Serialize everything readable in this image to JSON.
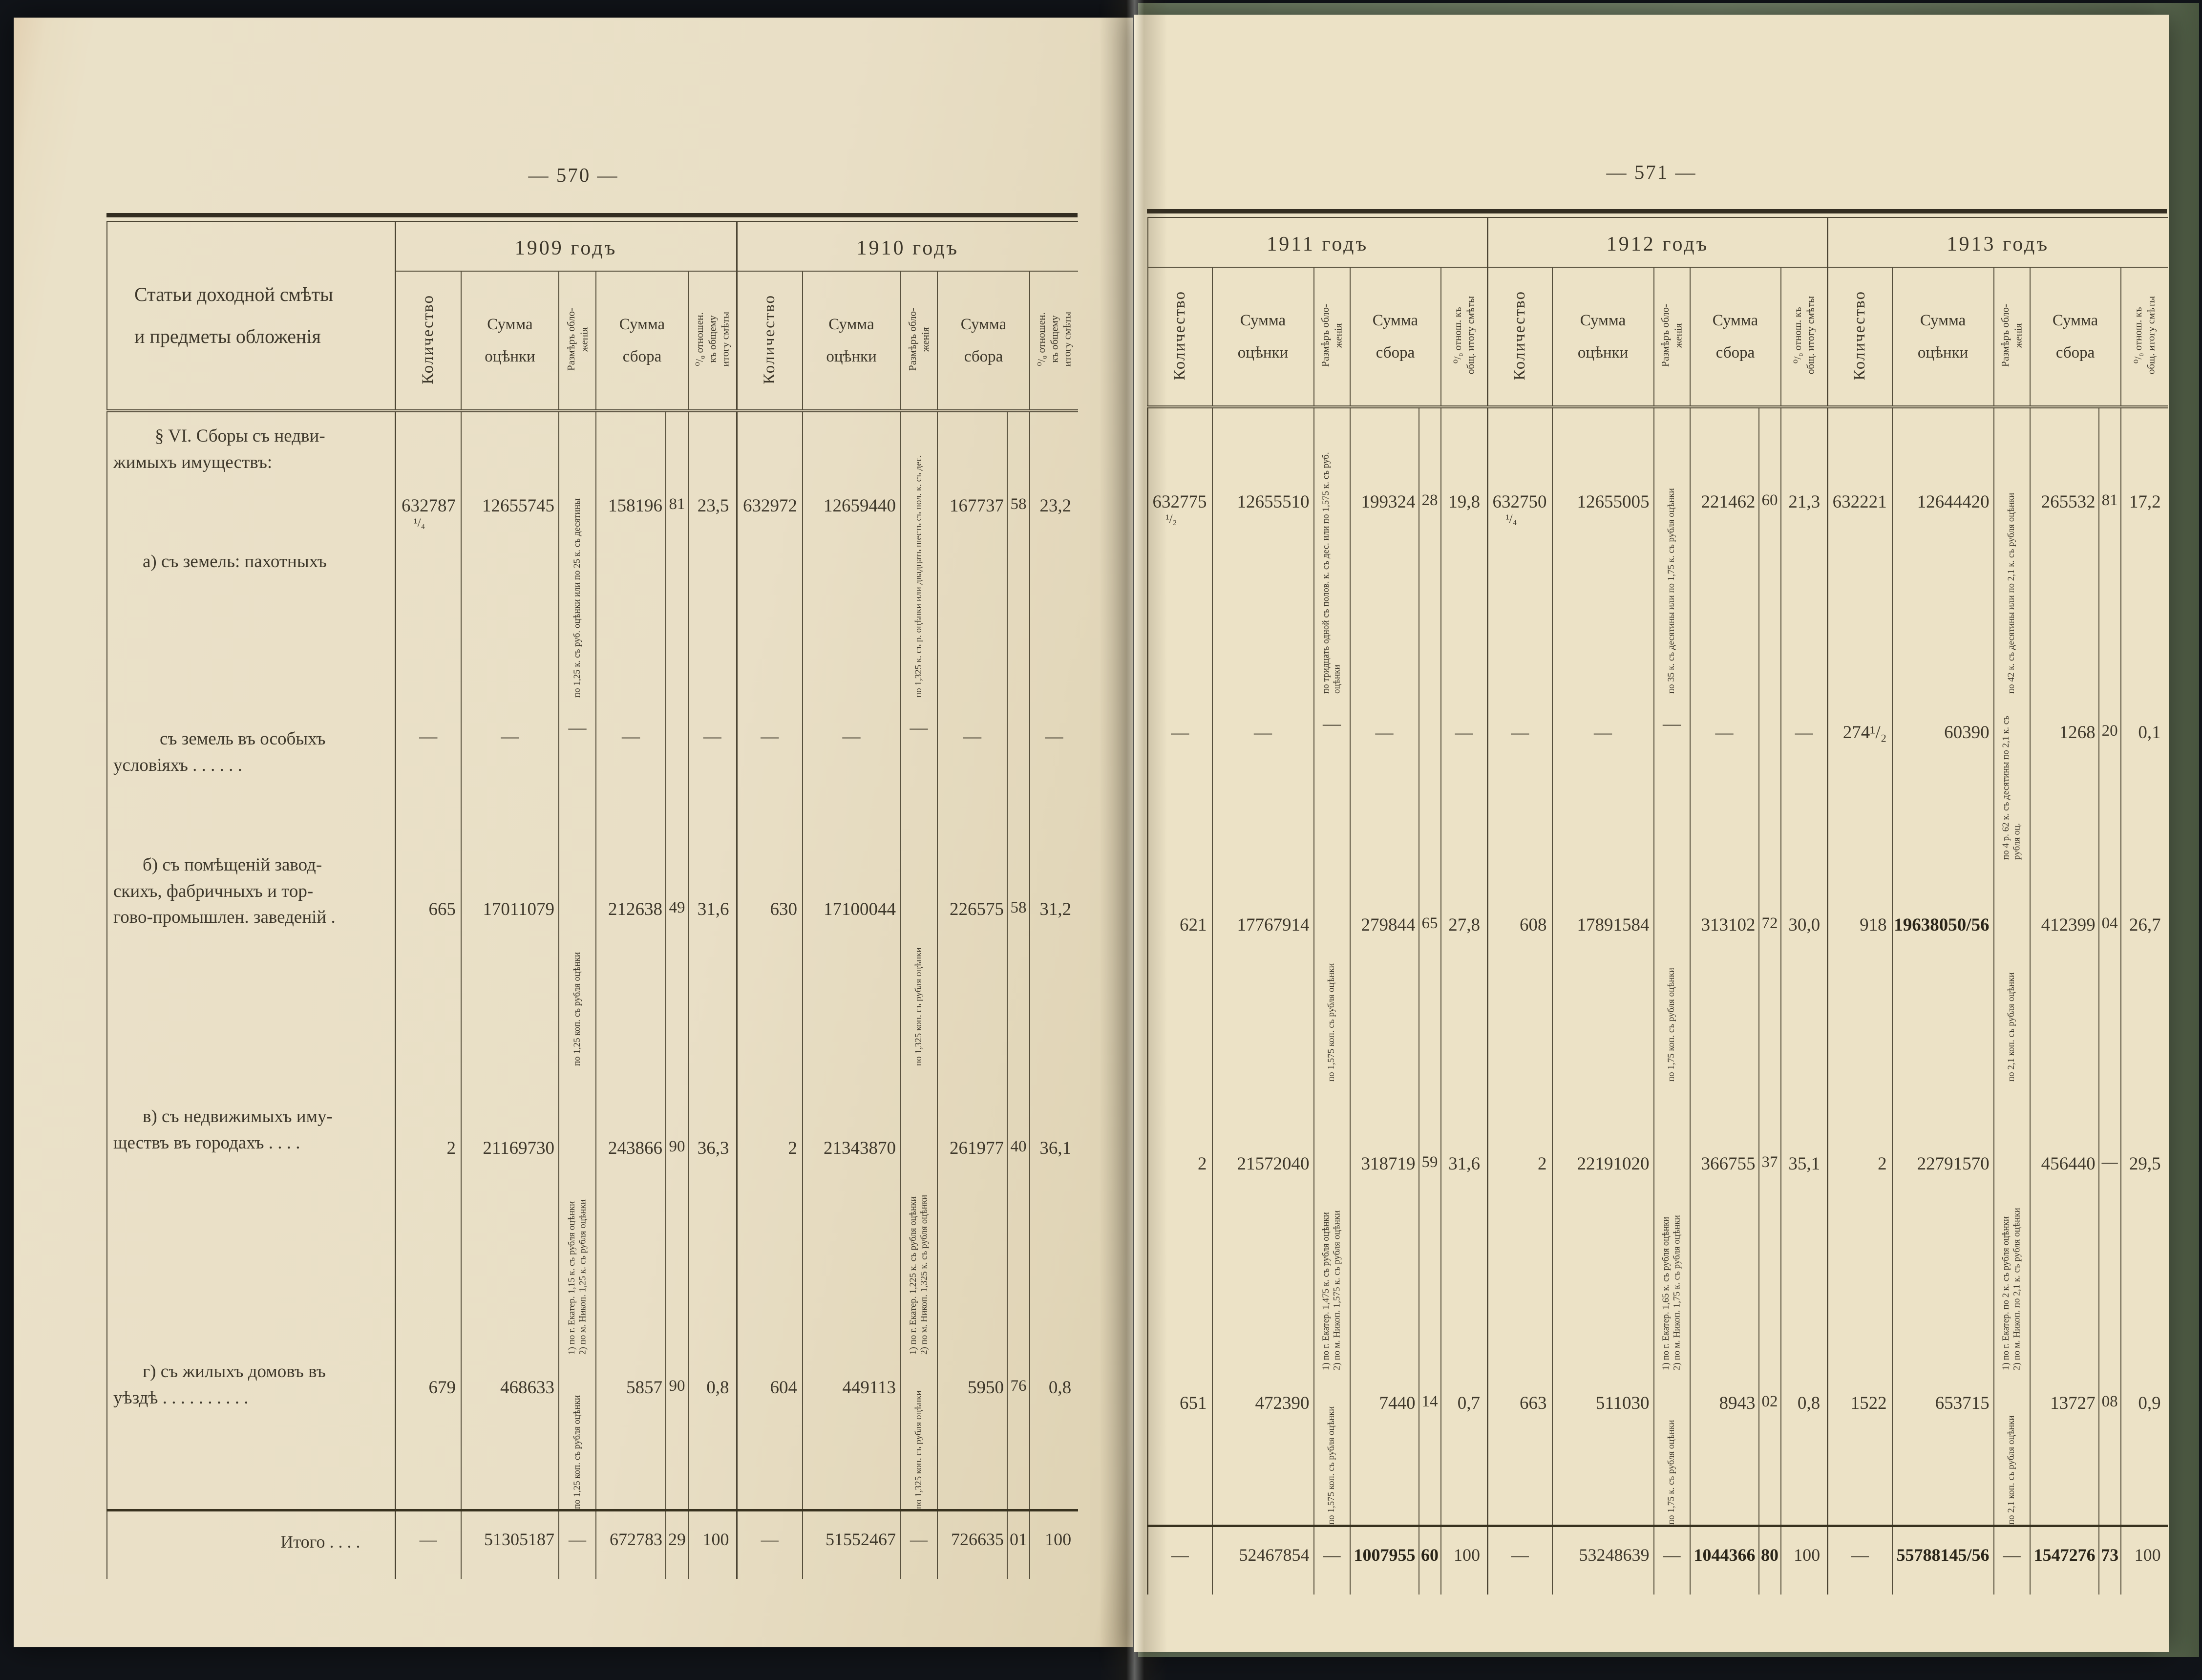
{
  "colors": {
    "paper_left": "#e9dfc6",
    "paper_right": "#ece2c6",
    "cover_green": "#6f7e64",
    "ink": "#3e382b",
    "rule": "#4c4534",
    "background": "#111419"
  },
  "page_left": {
    "page_number": "— 570 —",
    "stub": [
      "Статьи доходной смѣты",
      "и предметы обложенія"
    ],
    "years": [
      "1909 годъ",
      "1910 годъ"
    ]
  },
  "page_right": {
    "page_number": "— 571 —",
    "years": [
      "1911 годъ",
      "1912 годъ",
      "1913 годъ"
    ]
  },
  "columns": {
    "qty": "Количество",
    "assessment": "Сумма\nоцѣнки",
    "rate": "Размѣръ обло-\nженія",
    "levy": "Сумма\nсбора",
    "pct_left": "⁰/₀ отношен.\nкъ общему\nитогу смѣты",
    "pct_right": "⁰/₀ отнош. къ\nобщ. итогу смѣты"
  },
  "rows": [
    {
      "name": "section-a",
      "label": [
        "§ VI. Сборы съ недви-",
        "жимыхъ имуществъ:",
        "а) съ земель: пахотныхъ"
      ],
      "cells": {
        "y1909": {
          "qty": "632787",
          "qty_frac": "¹/₄",
          "val": "12655745",
          "rate": "по 1,25 к. съ руб. оцѣнки или по 25 к. съ десятины",
          "sum": "158196",
          "kop": "81",
          "pct": "23,5"
        },
        "y1910": {
          "qty": "632972",
          "val": "12659440",
          "rate": "по 1,325 к. съ р. оцѣнки или двадцать шесть съ пол. к. съ дес.",
          "sum": "167737",
          "kop": "58",
          "pct": "23,2"
        },
        "y1911": {
          "qty": "632775",
          "qty_frac": "¹/₂",
          "val": "12655510",
          "rate": "по тридцать одной съ полов. к. съ дес. или по 1,575 к. съ руб. оцѣнки",
          "sum": "199324",
          "kop": "28",
          "pct": "19,8"
        },
        "y1912": {
          "qty": "632750",
          "qty_frac": "¹/₄",
          "val": "12655005",
          "rate": "по 35 к. съ десятины или по 1,75 к. съ рубля оцѣнки",
          "sum": "221462",
          "kop": "60",
          "pct": "21,3"
        },
        "y1913": {
          "qty": "632221",
          "val": "12644420",
          "rate": "по 42 к. съ десятины или по 2,1 к. съ рубля оцѣнки",
          "sum": "265532",
          "kop": "81",
          "pct": "17,2"
        }
      }
    },
    {
      "name": "special",
      "label": [
        "съ земель въ особыхъ",
        "условіяхъ  .  .  .  .  .  ."
      ],
      "cells": {
        "y1909": {
          "qty": "—",
          "val": "—",
          "rate": "—",
          "sum": "—",
          "pct": "—"
        },
        "y1910": {
          "qty": "—",
          "val": "—",
          "rate": "—",
          "sum": "—",
          "pct": "—"
        },
        "y1911": {
          "qty": "—",
          "val": "—",
          "rate": "—",
          "sum": "—",
          "pct": "—"
        },
        "y1912": {
          "qty": "—",
          "val": "—",
          "rate": "—",
          "sum": "—",
          "pct": "—"
        },
        "y1913": {
          "qty": "274¹/₂",
          "val": "60390",
          "rate": "по 4 р. 62 к. съ десятины по 2,1 к. съ рубля оц.",
          "sum": "1268",
          "kop": "20",
          "pct": "0,1"
        }
      }
    },
    {
      "name": "b-premises",
      "label": [
        "б) съ помѣщеній завод-",
        "скихъ, фабричныхъ и тор-",
        "гово-промышлен. заведеній ."
      ],
      "cells": {
        "y1909": {
          "qty": "665",
          "val": "17011079",
          "rate": "по 1,25 коп. съ рубля оцѣнки",
          "sum": "212638",
          "kop": "49",
          "pct": "31,6"
        },
        "y1910": {
          "qty": "630",
          "val": "17100044",
          "rate": "по 1,325 коп. съ рубля оцѣнки",
          "sum": "226575",
          "kop": "58",
          "pct": "31,2"
        },
        "y1911": {
          "qty": "621",
          "val": "17767914",
          "rate": "по 1,575 коп. съ рубля оцѣнки",
          "sum": "279844",
          "kop": "65",
          "pct": "27,8"
        },
        "y1912": {
          "qty": "608",
          "val": "17891584",
          "rate": "по 1,75 коп. съ рубля оцѣнки",
          "sum": "313102",
          "kop": "72",
          "pct": "30,0"
        },
        "y1913": {
          "qty": "918",
          "val": "19638050/56",
          "val_bold": true,
          "rate": "по 2,1 коп. съ рубля оцѣнки",
          "sum": "412399",
          "kop": "04",
          "pct": "26,7"
        }
      }
    },
    {
      "name": "v-urban",
      "label": [
        "в) съ недвижимыхъ иму-",
        "ществъ въ городахъ .  .  .  ."
      ],
      "cells": {
        "y1909": {
          "qty": "2",
          "val": "21169730",
          "rate": "1) по г. Екатер. 1,15 к. съ рубля оцѣнки\n2) по м. Никоп. 1,25 к. съ рубля оцѣнки",
          "sum": "243866",
          "kop": "90",
          "pct": "36,3"
        },
        "y1910": {
          "qty": "2",
          "val": "21343870",
          "rate": "1) по г. Екатер. 1,225 к. съ рубля оцѣнки\n2) по м. Никоп. 1,325 к. съ рубля оцѣнки",
          "sum": "261977",
          "kop": "40",
          "pct": "36,1"
        },
        "y1911": {
          "qty": "2",
          "val": "21572040",
          "rate": "1) по г. Екатер. 1,475 к. съ рубля оцѣнки\n2) по м. Никоп. 1,575 к. съ рубля оцѣнки",
          "sum": "318719",
          "kop": "59",
          "pct": "31,6"
        },
        "y1912": {
          "qty": "2",
          "val": "22191020",
          "rate": "1) по г. Екатер. 1,65 к. съ рубля оцѣнки\n2) по м. Никоп. 1,75 к. съ рубля оцѣнки",
          "sum": "366755",
          "kop": "37",
          "pct": "35,1"
        },
        "y1913": {
          "qty": "2",
          "val": "22791570",
          "rate": "1) по г. Екатер. по 2 к. съ рубля оцѣнки\n2) по м. Никоп. по 2,1 к. съ рубля оцѣнки",
          "sum": "456440",
          "kop": "—",
          "pct": "29,5"
        }
      }
    },
    {
      "name": "g-houses",
      "label": [
        "г) съ жилыхъ домовъ въ",
        "уѣздѣ  .  .  .  .  .  .  .  .  .  ."
      ],
      "cells": {
        "y1909": {
          "qty": "679",
          "val": "468633",
          "rate": "по 1,25 коп. съ рубля оцѣнки",
          "sum": "5857",
          "kop": "90",
          "pct": "0,8"
        },
        "y1910": {
          "qty": "604",
          "val": "449113",
          "rate": "по 1,325 коп. съ рубля оцѣнки",
          "sum": "5950",
          "kop": "76",
          "pct": "0,8"
        },
        "y1911": {
          "qty": "651",
          "val": "472390",
          "rate": "по 1,575 коп. съ рубля оцѣнки",
          "sum": "7440",
          "kop": "14",
          "pct": "0,7"
        },
        "y1912": {
          "qty": "663",
          "val": "511030",
          "rate": "по 1,75 к. съ рубля оцѣнки",
          "sum": "8943",
          "kop": "02",
          "pct": "0,8"
        },
        "y1913": {
          "qty": "1522",
          "val": "653715",
          "rate": "по 2,1 коп. съ рубля оцѣнки",
          "sum": "13727",
          "kop": "08",
          "pct": "0,9"
        }
      }
    },
    {
      "name": "itogo",
      "label": [
        "Итого  .  .  .  ."
      ],
      "cells": {
        "y1909": {
          "qty": "—",
          "val": "51305187",
          "rate": "—",
          "sum": "672783",
          "kop": "29",
          "pct": "100"
        },
        "y1910": {
          "qty": "—",
          "val": "51552467",
          "rate": "—",
          "sum": "726635",
          "kop": "01",
          "pct": "100"
        },
        "y1911": {
          "qty": "—",
          "val": "52467854",
          "rate": "—",
          "sum": "1007955",
          "kop": "60",
          "sum_bold": true,
          "pct": "100"
        },
        "y1912": {
          "qty": "—",
          "val": "53248639",
          "rate": "—",
          "sum": "1044366",
          "kop": "80",
          "sum_bold": true,
          "pct": "100"
        },
        "y1913": {
          "qty": "—",
          "val": "55788145/56",
          "val_bold": true,
          "rate": "—",
          "sum": "1547276",
          "kop": "73",
          "sum_bold": true,
          "pct": "100"
        }
      }
    }
  ]
}
